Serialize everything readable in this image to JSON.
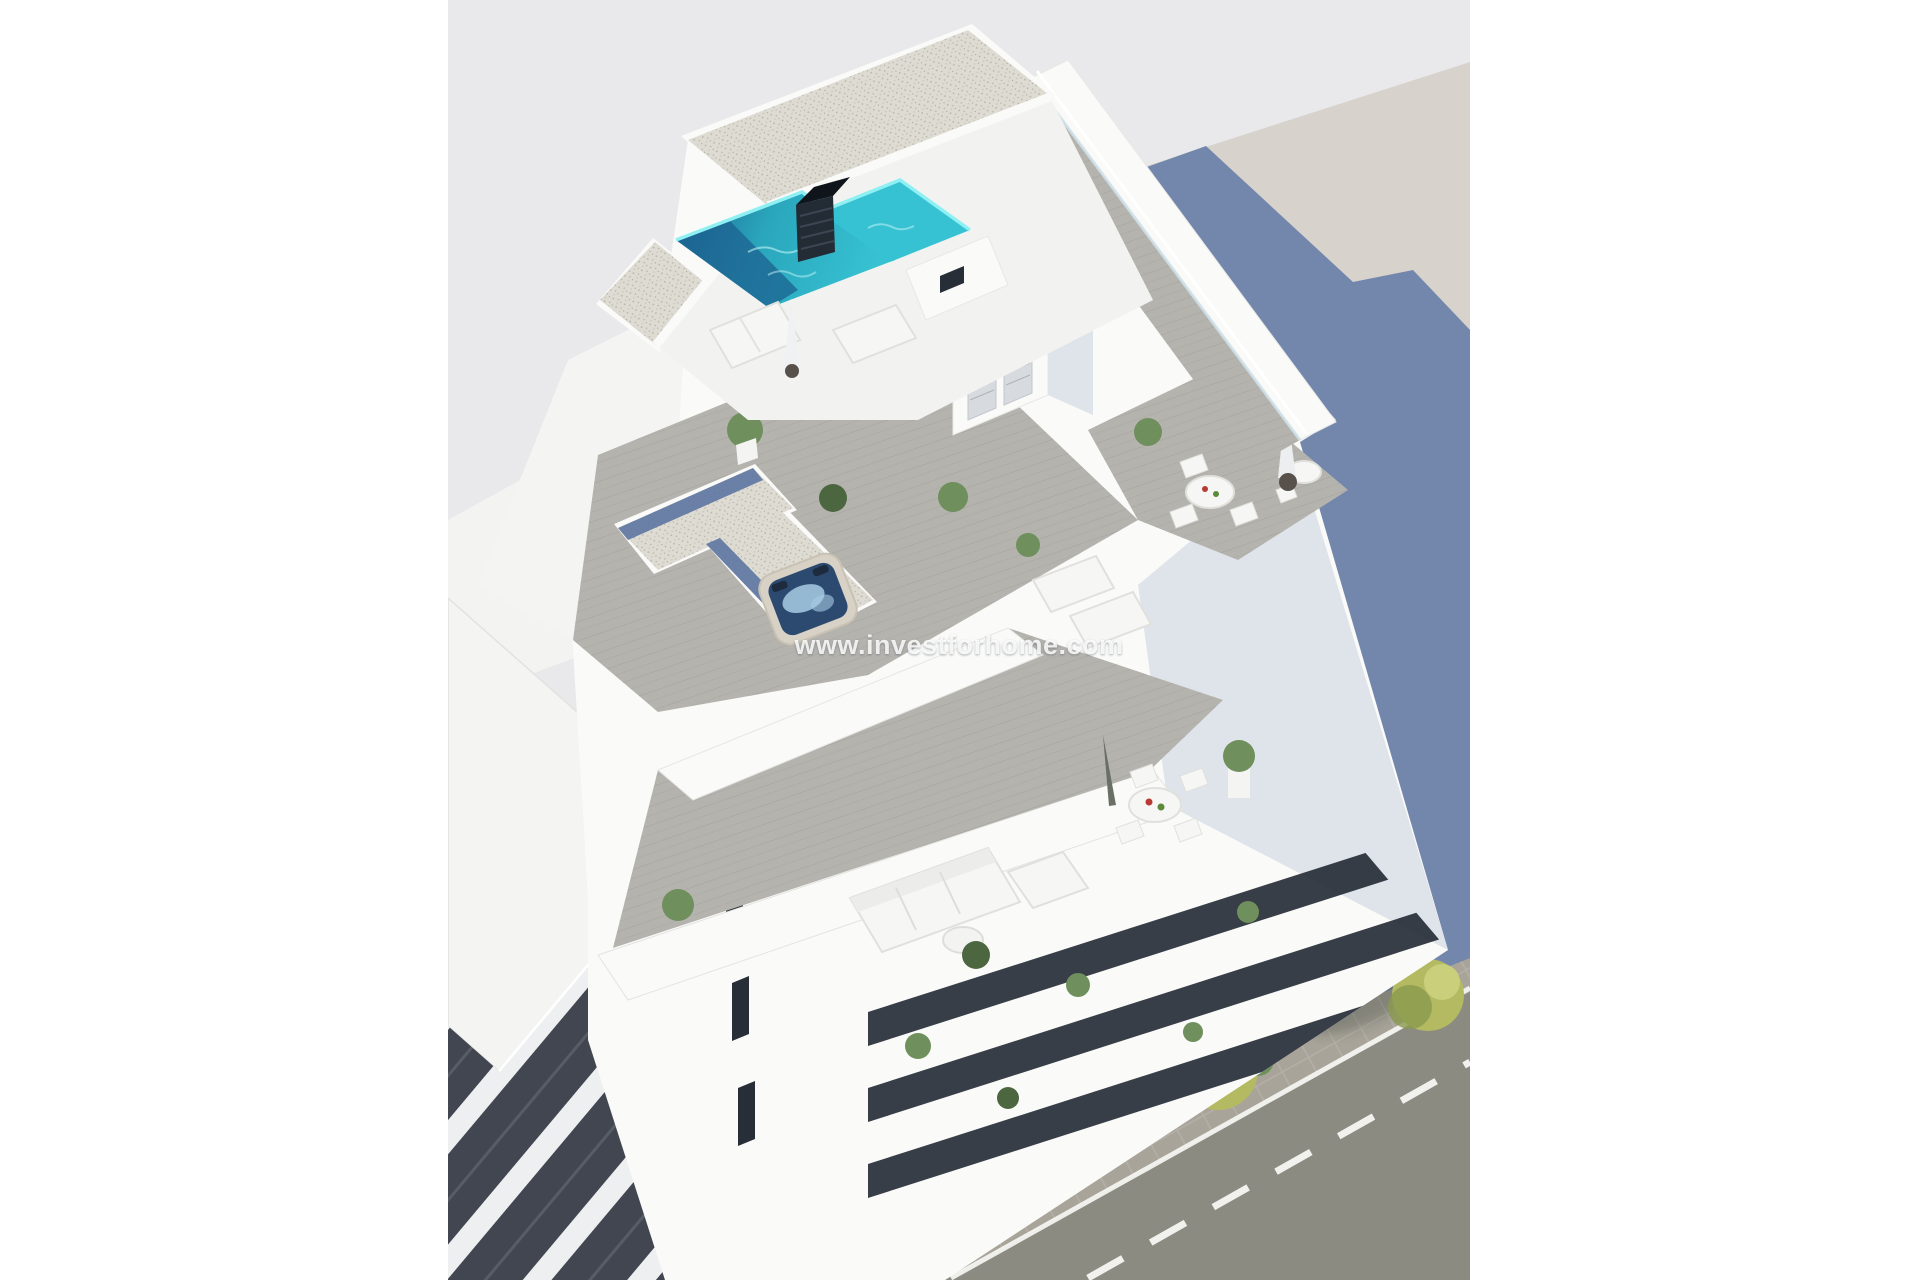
{
  "image": {
    "kind": "3d-architectural-render",
    "view": "aerial-isometric",
    "subject": "Modern white apartment building with rooftop pool, jacuzzi and furnished roof terraces, neighbouring buildings and a street with trees"
  },
  "watermark": {
    "text": "www.investforhome.com"
  },
  "palette": {
    "sky": "#e9e9eb",
    "ground": "#d7d3cc",
    "shadow": "#6e83ab",
    "asphalt": "#8b8b81",
    "sidewalk": "#a9a49a",
    "road_marking": "#f7f7f3",
    "tree": "#b4ba62",
    "tree_light": "#ccd17e",
    "tree_dark": "#8a9a4e",
    "gravel": "#dedbd3",
    "gravel_dot": "#b7b3a8",
    "gravel_blue": "#5d76a1",
    "deck": "#b5b3ae",
    "deck_line": "#918f8a",
    "wall_white": "#fafaf8",
    "wall_lit": "#f4f4f2",
    "wall_shade": "#dfe3ea",
    "glass_dark": "#272e37",
    "pool_water": "#36c2d2",
    "pool_deep": "#1c6290",
    "pool_rim": "#8ef0f2",
    "pool_texture": "#bff3f5",
    "jacuzzi_water": "#2c4a70",
    "jacuzzi_foam": "#a8cbe4",
    "jacuzzi_shell": "#d8d2c6",
    "plant": "#6f8f5d",
    "plant_dark": "#4c663f",
    "furniture": "#f6f6f4",
    "furniture_edge": "#e0e0dc",
    "neighbor_dark": "#414650",
    "neighbor_slab": "#edeff0",
    "umbrella_base": "#58504a",
    "accent_red": "#b83a32",
    "accent_green": "#5a8a3a",
    "watermark": "rgba(255,255,255,0.85)"
  }
}
